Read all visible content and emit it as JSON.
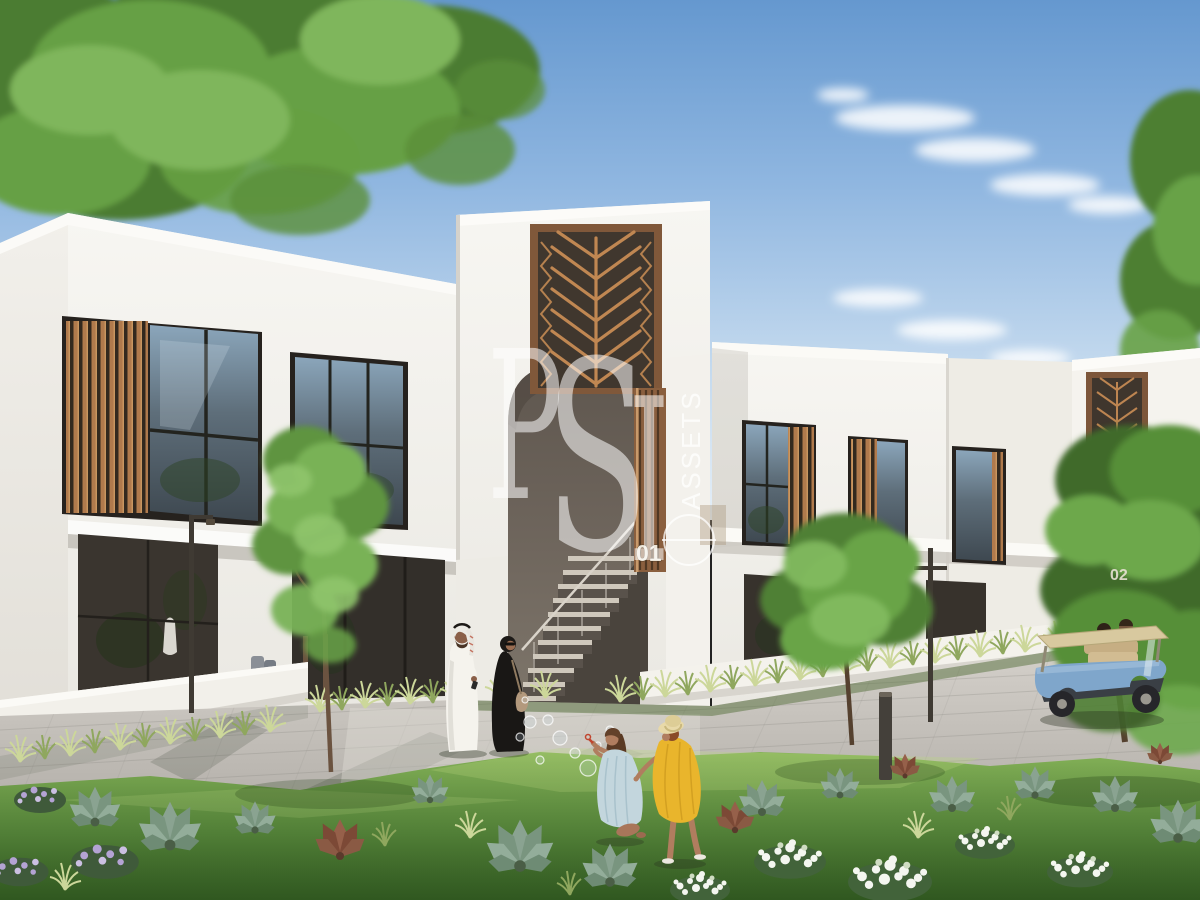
{
  "scene": {
    "type": "architectural-exterior-render",
    "subject": "modern white two-storey townhouses with bronze mashrabiya screens, landscaped garden, residents and golf cart"
  },
  "watermark": {
    "brand_letters": [
      "P",
      "S",
      "I"
    ],
    "brand_sub": "ASSETS",
    "logo_icon": "circle-line-logo",
    "color": "#FFFFFF"
  },
  "building_labels": {
    "unit_left": "01",
    "unit_right": "02",
    "label_color": "#EDE6D9"
  },
  "palette": {
    "sky_top": "#6598CF",
    "sky_horizon": "#E4EEF7",
    "facade_white": "#F6F5F1",
    "bronze_screen": "#B5814F",
    "alcove_shadow": "#6A6158",
    "window_glass": "#46525C",
    "lawn_green": "#6FA047",
    "pavement_grey": "#C9C5BF",
    "golf_cart_blue": "#7FA6CB",
    "kandura_white": "#F5F3ED",
    "abaya_black": "#191715",
    "dress_yellow": "#E9B52C",
    "dress_blue": "#C3D6DD"
  },
  "figures": [
    "man-in-kandura",
    "woman-in-abaya",
    "girl-blowing-bubbles",
    "girl-in-yellow-dress",
    "golf-cart-with-riders"
  ]
}
